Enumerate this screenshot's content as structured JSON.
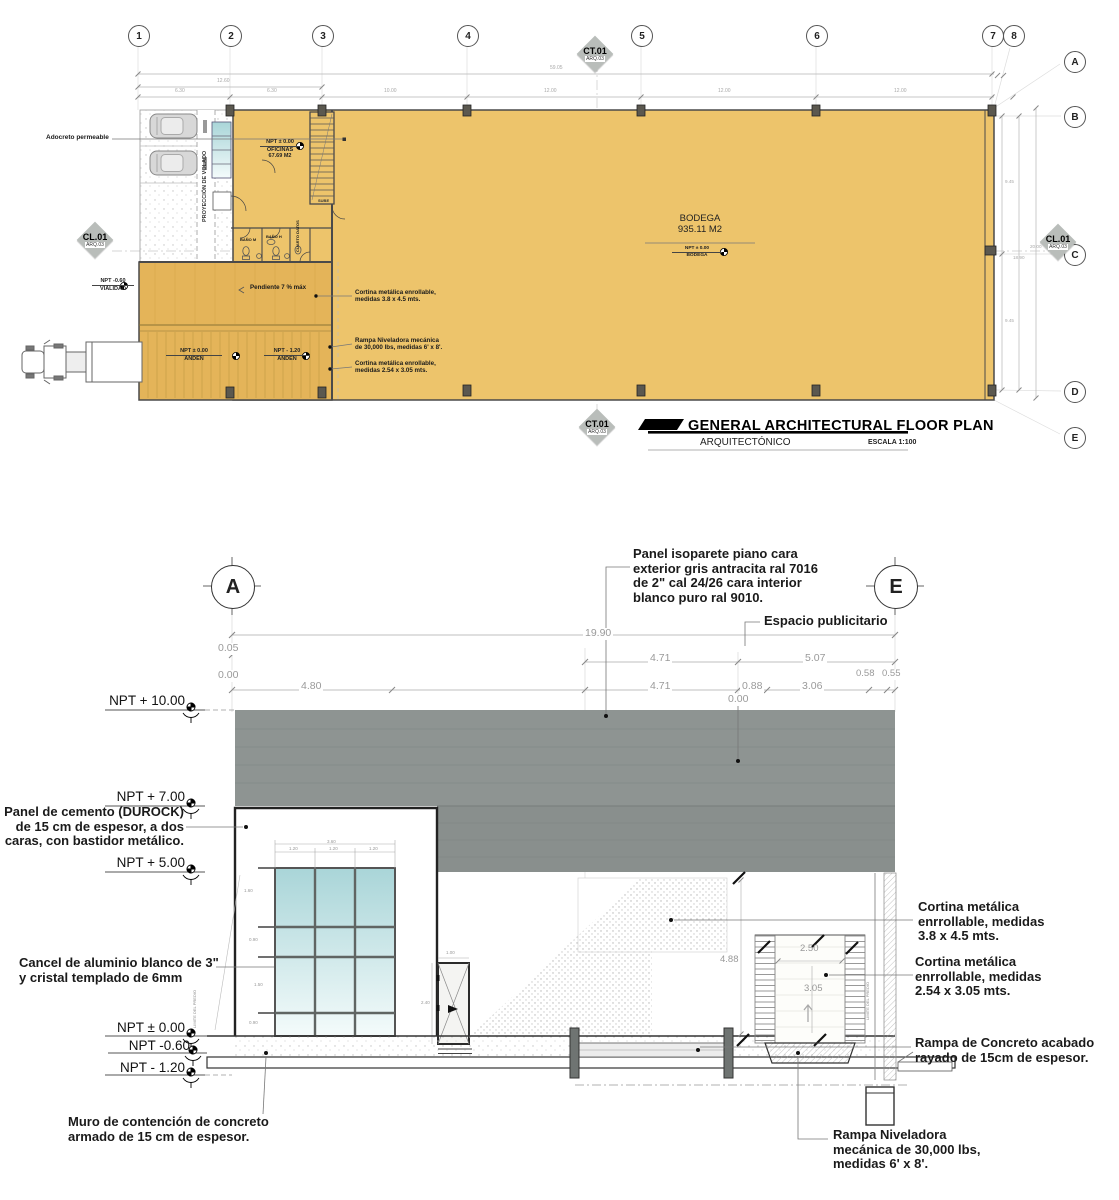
{
  "plan": {
    "grids_top": [
      "1",
      "2",
      "3",
      "4",
      "5",
      "6",
      "7",
      "8"
    ],
    "grids_right": [
      "A",
      "B",
      "C",
      "D",
      "E"
    ],
    "ct01": "CT.01",
    "cl01": "CL.01",
    "arq03": "ARQ.03",
    "dims": {
      "overall": "59.05",
      "pair": "12.60",
      "s1": "6.30",
      "s2": "6.30",
      "s3": "10.00",
      "s4": "12.00",
      "s5": "12.00",
      "s6": "12.00",
      "v945a": "9.45",
      "v945b": "9.45",
      "v1890": "18.90",
      "v2000": "20.00"
    },
    "adocreto": "Adocreto permeable",
    "volado": "PROYECCIÓN DE VOLADO",
    "of_npt": "NPT ± 0.00",
    "of_name": "OFICINAS",
    "of_area": "67.69 M2",
    "sube": "SUBE",
    "bano_m": "BAÑO M",
    "bano_h": "BAÑO H",
    "cuarto": "CUARTO DATOS",
    "vial_npt": "NPT -0.60",
    "vial_name": "VIALIDAD",
    "pend": "Pendiente 7 % máx",
    "cort1": "Cortina metálica enrollable,\nmedidas 3.8 x 4.5 mts.",
    "anden0_npt": "NPT ± 0.00",
    "anden0_name": "ANDEN",
    "anden1_npt": "NPT - 1.20",
    "anden1_name": "ANDEN",
    "rampa": "Rampa Niveladora mecánica\nde 30,000 lbs, medidas 6' x 8'.",
    "cort2": "Cortina metálica enrollable,\nmedidas 2.54 x 3.05 mts.",
    "bodega_name": "BODEGA",
    "bodega_area": "935.11 M2",
    "bodega_npt": "NPT ± 0.00",
    "bodega_sub": "BODEGA",
    "title": "GENERAL ARCHITECTURAL FLOOR PLAN",
    "subtitle": "ARQUITECTÓNICO",
    "scale": "ESCALA 1:100"
  },
  "elev": {
    "bubble_a": "A",
    "bubble_e": "E",
    "panel_iso": "Panel isoparete piano cara\nexterior gris antracita ral 7016\nde 2\" cal 24/26 cara interior\nblanco puro ral 9010.",
    "espacio": "Espacio publicitario",
    "d1990": "19.90",
    "d005": "0.05",
    "d000a": "0.00",
    "d480": "4.80",
    "d471a": "4.71",
    "d507": "5.07",
    "d471b": "4.71",
    "d088": "0.88",
    "d306": "3.06",
    "d058": "0.58",
    "d055": "0.55",
    "d000b": "0.00",
    "npt10": "NPT + 10.00",
    "npt7": "NPT + 7.00",
    "npt5": "NPT + 5.00",
    "npt0": "NPT ± 0.00",
    "npt06": "NPT -0.60",
    "npt12": "NPT - 1.20",
    "durock": "Panel de cemento (DUROCK)\nde 15 cm de espesor, a dos\ncaras, con bastidor metálico.",
    "cancel": "Cancel de aluminio blanco de 3\"\ny cristal templado de 6mm",
    "muro": "Muro de contención de concreto\narmado de 15 cm de espesor.",
    "cort38": "Cortina metálica\nenrrollable, medidas\n3.8 x 4.5 mts.",
    "cort254": "Cortina metálica\nenrrollable, medidas\n2.54 x 3.05 mts.",
    "rampa_conc": "Rampa de Concreto acabado\nrayado de 15cm de espesor.",
    "rampa_niv": "Rampa Niveladora\nmecánica de 30,000 lbs,\nmedidas 6' x 8'.",
    "w360": "3.60",
    "w120a": "1.20",
    "w120b": "1.20",
    "w120c": "1.20",
    "h160": "1.60",
    "h090a": "0.90",
    "h150": "1.50",
    "h090b": "0.90",
    "d100": "1.00",
    "d240": "2.40",
    "d488": "4.88",
    "d250": "2.50",
    "d305": "3.05",
    "limite": "LIMITE DEL PREDIO"
  },
  "colors": {
    "floor": "#edc46b",
    "ramp": "#e4b459",
    "panel_gray": "#8e9492",
    "glass": "#a9d5d8"
  }
}
